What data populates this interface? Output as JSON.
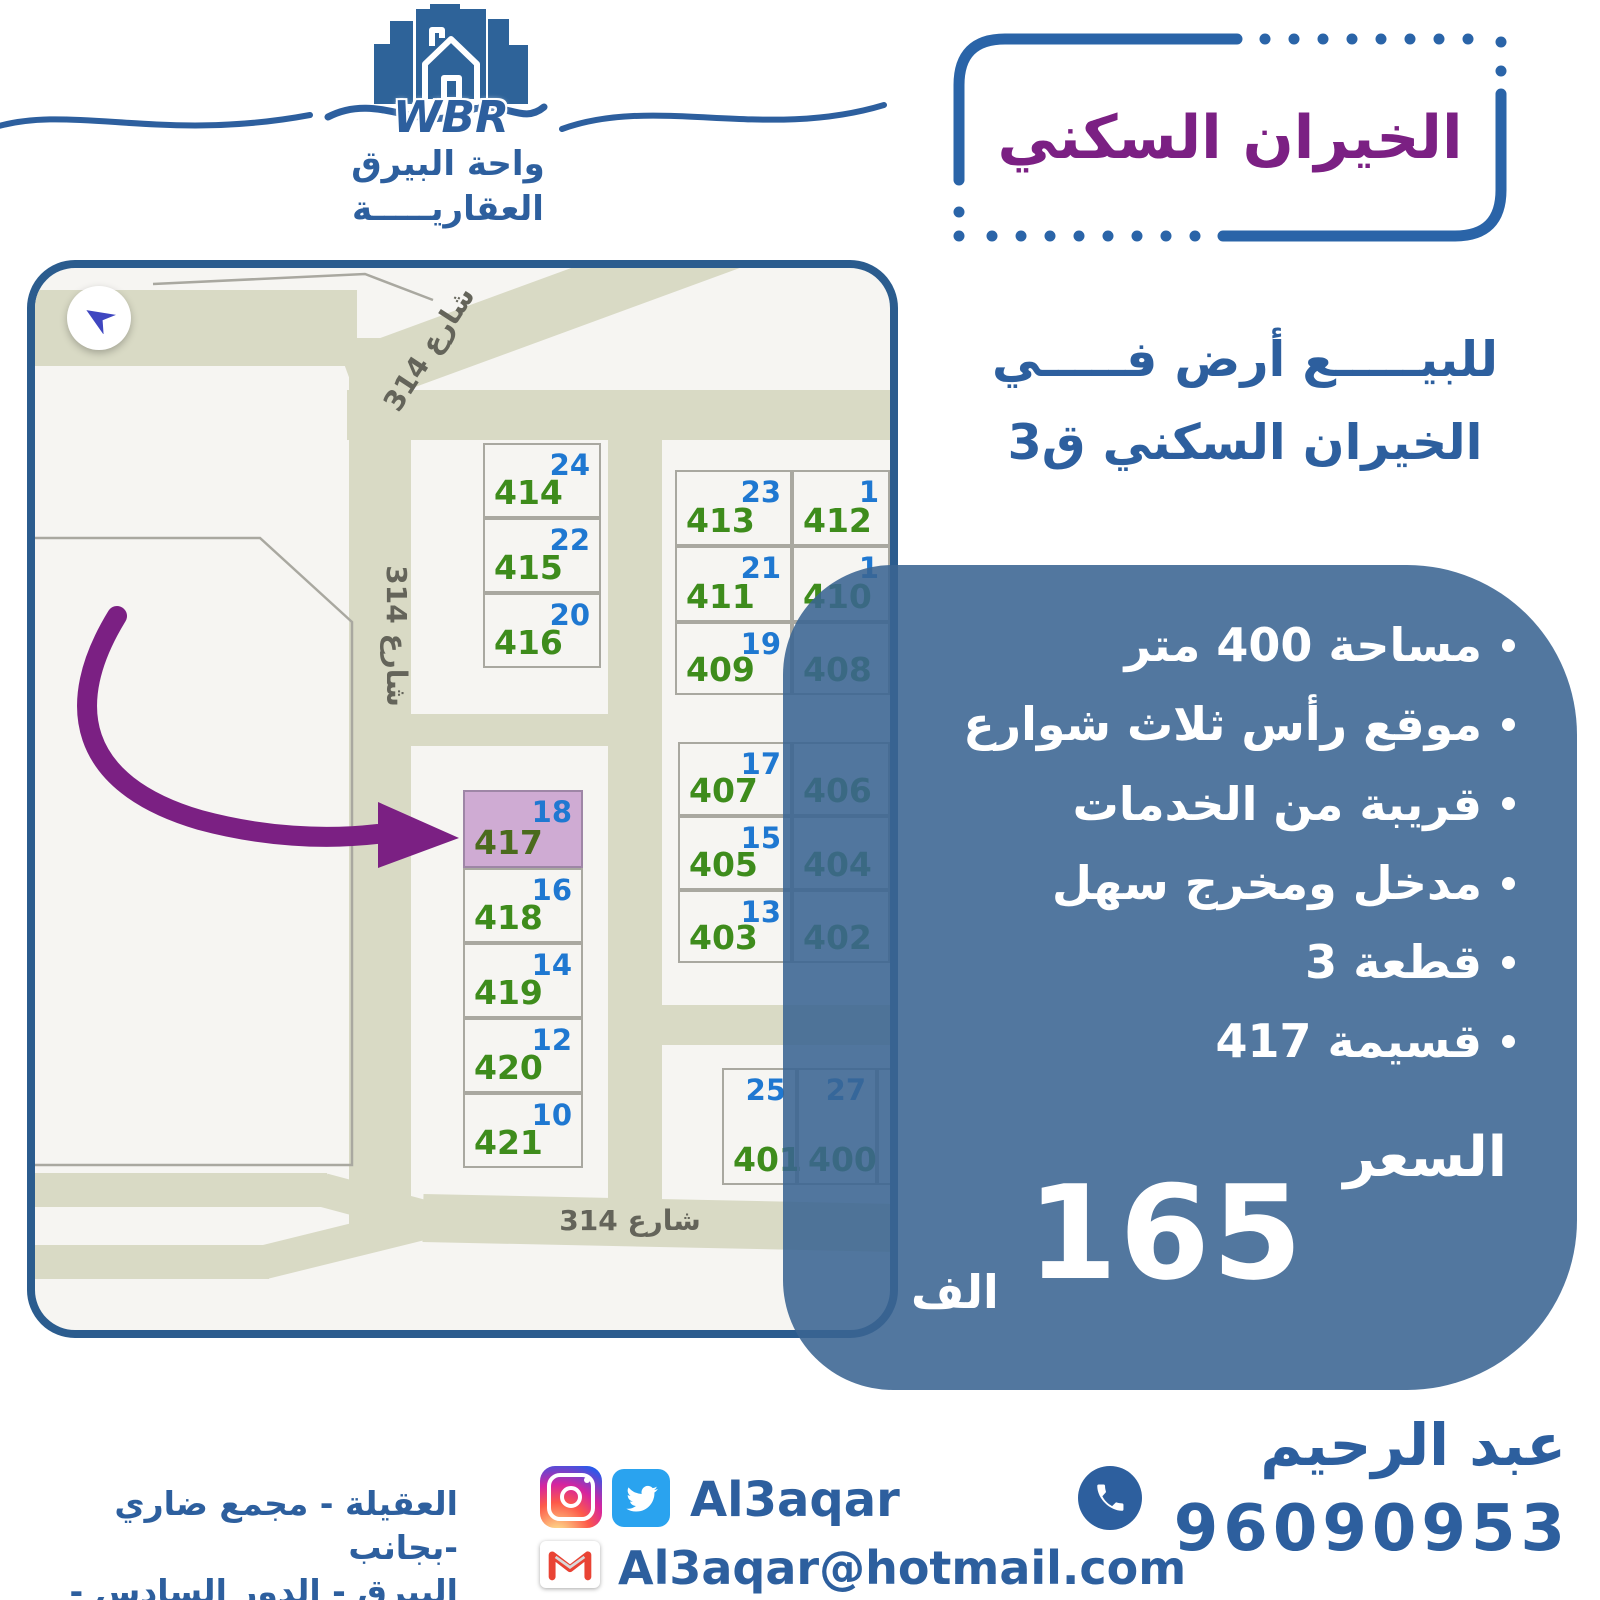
{
  "brand": {
    "acronym": "WBR",
    "name_line1": "واحة البيرق",
    "name_line2": "العقاريـــــة"
  },
  "title_box": {
    "title": "الخيران السكني"
  },
  "subtitle": {
    "line1": "للبيـــــع أرض فـــــي",
    "line2": "الخيران السكني ق3"
  },
  "map": {
    "street_label": "شارع 314",
    "plots": [
      {
        "green": "414",
        "blue": "24"
      },
      {
        "green": "415",
        "blue": "22"
      },
      {
        "green": "416",
        "blue": "20"
      },
      {
        "green": "417",
        "blue": "18",
        "highlighted": true
      },
      {
        "green": "418",
        "blue": "16"
      },
      {
        "green": "419",
        "blue": "14"
      },
      {
        "green": "420",
        "blue": "12"
      },
      {
        "green": "421",
        "blue": "10"
      },
      {
        "green": "413",
        "blue": "23"
      },
      {
        "green": "412",
        "blue": "1"
      },
      {
        "green": "411",
        "blue": "21"
      },
      {
        "green": "410",
        "blue": "1"
      },
      {
        "green": "409",
        "blue": "19"
      },
      {
        "green": "408",
        "blue": ""
      },
      {
        "green": "407",
        "blue": "17"
      },
      {
        "green": "406",
        "blue": ""
      },
      {
        "green": "405",
        "blue": "15"
      },
      {
        "green": "404",
        "blue": ""
      },
      {
        "green": "403",
        "blue": "13"
      },
      {
        "green": "402",
        "blue": ""
      },
      {
        "green": "401",
        "blue": "25"
      },
      {
        "green": "400",
        "blue": "27"
      }
    ]
  },
  "details": {
    "bullets": [
      "مساحة 400 متر",
      "موقع رأس ثلاث شوارع",
      "قريبة من الخدمات",
      "مدخل ومخرج سهل",
      "قطعة 3",
      "قسيمة 417"
    ],
    "price_label": "السعر",
    "price_value": "165",
    "price_unit": "الف"
  },
  "footer": {
    "agent_name": "عبد الرحيم",
    "phone": "96090953",
    "social_handle": "Al3aqar",
    "email": "Al3aqar@hotmail.com",
    "address_line1": "العقيلة - مجمع ضاري -بجانب",
    "address_line2": "البيرق - الدور السادس - مكتب 6"
  },
  "colors": {
    "accent": "#2d5f9e",
    "border_blue": "#2a64a8",
    "map_border": "#2b5c8e",
    "purple": "#7b2083",
    "panel": "rgba(58,100,146,0.88)",
    "road": "#d9dac5",
    "map_bg": "#f6f5f2",
    "plot_green": "#3e8c1c",
    "plot_blue": "#1f78d1",
    "highlight": "#cfabd3",
    "twitter": "#2aa3ef",
    "gmail_red": "#e94334"
  }
}
